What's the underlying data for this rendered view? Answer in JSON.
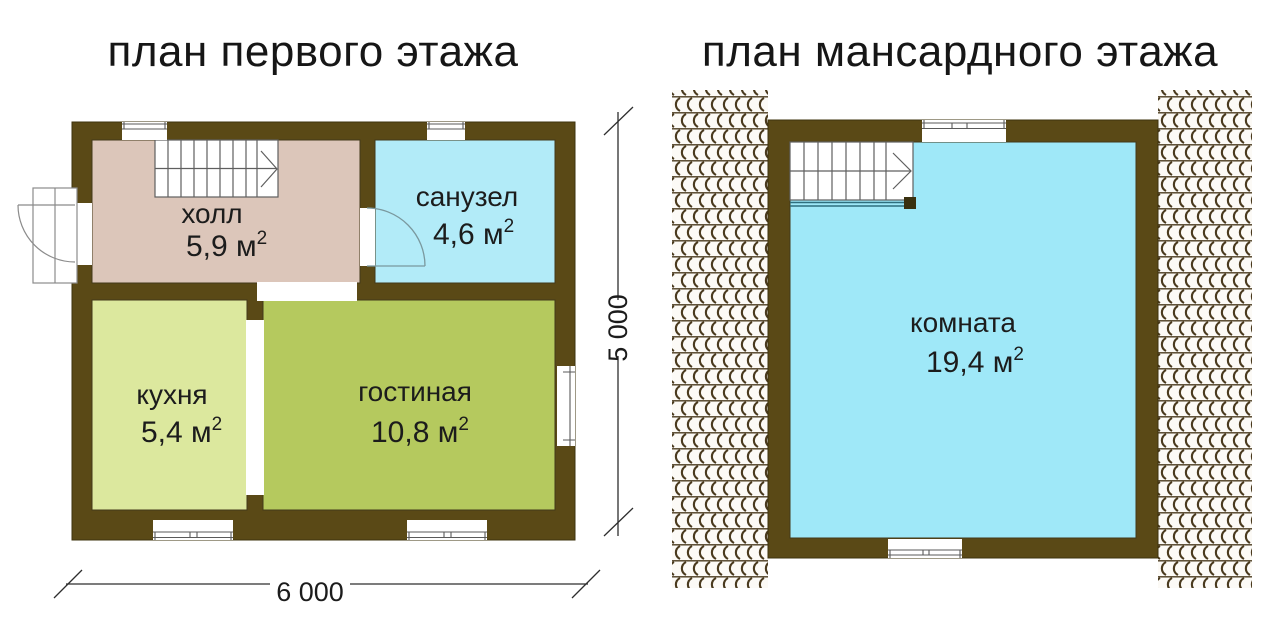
{
  "colors": {
    "wall": "#5a4916",
    "wall_outline": "#3e330e",
    "hall": "#dcc6ba",
    "bathroom": "#b2ebf8",
    "kitchen": "#dce89e",
    "living": "#b5c95e",
    "attic_room": "#9fe8f8",
    "tile_hatch": "#4a3a1e",
    "dimension_line": "#2e2e2e"
  },
  "floor1": {
    "title": "план первого этажа",
    "rooms": [
      {
        "id": "hall",
        "name": "холл",
        "area": "5,9 м",
        "area_sup": "2"
      },
      {
        "id": "bathroom",
        "name": "санузел",
        "area": "4,6 м",
        "area_sup": "2"
      },
      {
        "id": "kitchen",
        "name": "кухня",
        "area": "5,4 м",
        "area_sup": "2"
      },
      {
        "id": "living",
        "name": "гостиная",
        "area": "10,8 м",
        "area_sup": "2"
      }
    ],
    "dimensions": {
      "width_label": "6 000",
      "height_label": "5 000"
    }
  },
  "floor2": {
    "title": "план мансардного этажа",
    "rooms": [
      {
        "id": "attic-room",
        "name": "комната",
        "area": "19,4 м",
        "area_sup": "2"
      }
    ]
  }
}
